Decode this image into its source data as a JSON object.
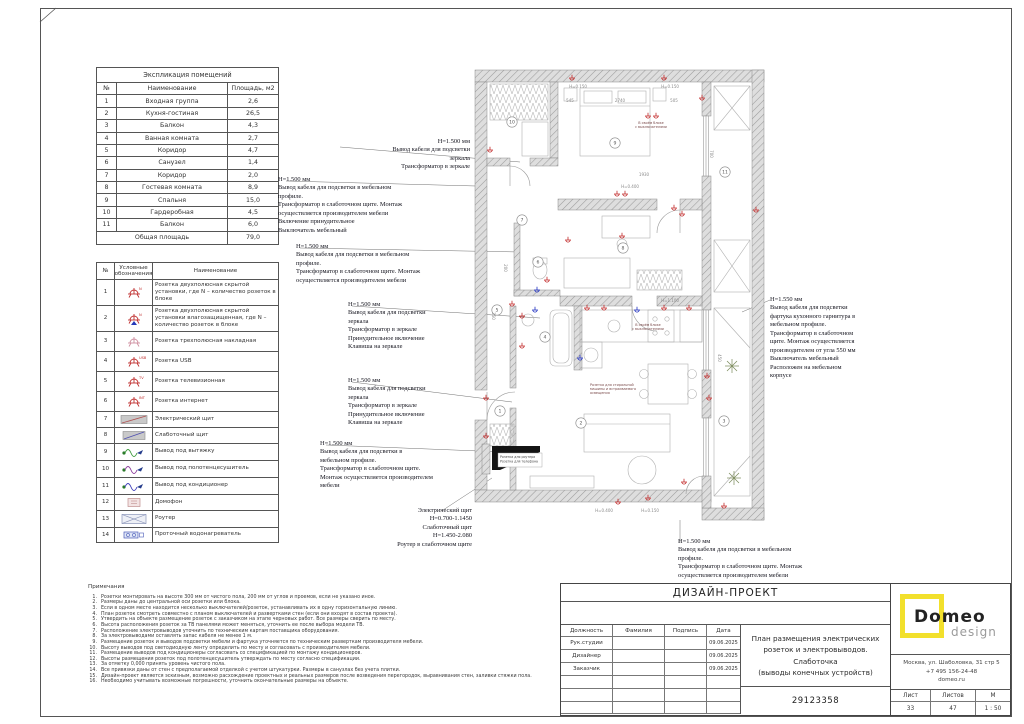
{
  "explication": {
    "title": "Экспликация помещений",
    "headers": [
      "№",
      "Наименование",
      "Площадь, м2"
    ],
    "rows": [
      [
        "1",
        "Входная группа",
        "2,6"
      ],
      [
        "2",
        "Кухня-гостиная",
        "26,5"
      ],
      [
        "3",
        "Балкон",
        "4,3"
      ],
      [
        "4",
        "Ванная комната",
        "2,7"
      ],
      [
        "5",
        "Коридор",
        "4,7"
      ],
      [
        "6",
        "Санузел",
        "1,4"
      ],
      [
        "7",
        "Коридор",
        "2,0"
      ],
      [
        "8",
        "Гостевая комната",
        "8,9"
      ],
      [
        "9",
        "Спальня",
        "15,0"
      ],
      [
        "10",
        "Гардеробная",
        "4,5"
      ],
      [
        "11",
        "Балкон",
        "6,0"
      ]
    ],
    "total_label": "Общая площадь",
    "total_value": "79,0"
  },
  "legend": {
    "headers": [
      "№",
      "Условные обозначения",
      "Наименование"
    ],
    "rows": [
      {
        "num": "1",
        "icon": "socket",
        "name": "Розетка двухполюсная скрытой установки, где N – количество розеток в блоке"
      },
      {
        "num": "2",
        "icon": "socket-wet",
        "name": "Розетка двухполюсная скрытой установки влагозащищенная, где N – количество розеток в блоке"
      },
      {
        "num": "3",
        "icon": "socket-surface",
        "name": "Розетка трехполюсная накладная"
      },
      {
        "num": "4",
        "icon": "socket-usb",
        "name": "Розетка USB"
      },
      {
        "num": "5",
        "icon": "socket-tv",
        "name": "Розетка телевизионная"
      },
      {
        "num": "6",
        "icon": "socket-int",
        "name": "Розетка интернет"
      },
      {
        "num": "7",
        "icon": "panel-el",
        "name": "Электрический щит"
      },
      {
        "num": "8",
        "icon": "panel-low",
        "name": "Слаботочный щит"
      },
      {
        "num": "9",
        "icon": "out-hood",
        "name": "Вывод под вытяжку"
      },
      {
        "num": "10",
        "icon": "out-towel",
        "name": "Вывод под полотенцесушитель"
      },
      {
        "num": "11",
        "icon": "out-ac",
        "name": "Вывод под кондиционер"
      },
      {
        "num": "12",
        "icon": "intercom",
        "name": "Домофон"
      },
      {
        "num": "13",
        "icon": "router",
        "name": "Роутер"
      },
      {
        "num": "14",
        "icon": "heater",
        "name": "Проточный водонагреватель"
      }
    ]
  },
  "annotations": [
    {
      "x": 302,
      "y": 138,
      "w": 168,
      "align": "right",
      "text": "H=1.500 мм\nВывод кабеля для подсветки\nзеркала\nТрансформатор в зеркале"
    },
    {
      "x": 278,
      "y": 176,
      "w": 196,
      "align": "left",
      "text": "H=1.500 мм\nВывод кабеля для подсветки в мебельном\nпрофиле.\nТрансформатор в слаботочном щите. Монтаж\nосуществляется производителем  мебели\nВключение принудительное\nВыключатель мебельный"
    },
    {
      "x": 296,
      "y": 243,
      "w": 184,
      "align": "left",
      "text": "H=1.500 мм\nВывод кабеля для подсветки в мебельном\nпрофиле.\nТрансформатор в слаботочном щите. Монтаж\nосуществляется производителем  мебели"
    },
    {
      "x": 348,
      "y": 301,
      "w": 122,
      "align": "left",
      "text": "H=1.500 мм\nВывод кабеля для подсветки\nзеркала\nТрансформатор в зеркале\nПринудительное включение\nКлавиша на зеркале"
    },
    {
      "x": 348,
      "y": 377,
      "w": 122,
      "align": "left",
      "text": "H=1.500 мм\nВывод кабеля для подсветки\nзеркала\nТрансформатор в зеркале\nПринудительное включение\nКлавиша на зеркале"
    },
    {
      "x": 320,
      "y": 440,
      "w": 152,
      "align": "left",
      "text": "H=1.500 мм\nВывод кабеля для подсветки в\nмебельном профиле.\nТрансформатор в слаботочном щите.\nМонтаж осуществляется производителем\nмебели"
    },
    {
      "x": 342,
      "y": 507,
      "w": 130,
      "align": "right",
      "text": "Электрический щит\nH=0.700-1.1450\nСлаботочный щит\nH=1.450-2.080\nРоутер в слаботочном щите"
    },
    {
      "x": 770,
      "y": 296,
      "w": 106,
      "align": "left",
      "text": "H=1.550 мм\nВывод кабеля для подсветки\nфартука кухонного гарнитура в\nмебельном профиле.\nТрансформатор в слаботочном\nщите. Монтаж осуществляется\nпроизводителем от угла  550 мм\nВыключатель мебельный\nРасположен на мебельном\nкорпусе"
    },
    {
      "x": 678,
      "y": 538,
      "w": 206,
      "align": "left",
      "text": "H=1.500 мм\nВывод кабеля для подсветки в мебельном\nпрофиле.\nТрансформатор в слаботочном щите. Монтаж\nосуществляется производителем  мебели"
    }
  ],
  "notes": {
    "title": "Примечания",
    "items": [
      "Розетки монтировать на высоте 300 мм от чистого пола, 200 мм от углов и проемов, если не указано иное.",
      "Размеры даны до центральной оси розетки или блока.",
      "Если в одном месте находится несколько выключателей/розеток, устанавливать их в одну горизонтальную линию.",
      "План розеток смотреть совместно с планом выключателей и развертками стен (если они входят в состав проекта).",
      "Утвердить на объекте размещение розеток с заказчиком на этапе черновых работ. Все размеры сверить по месту.",
      "Высота расположения розеток за ТВ панелями может меняться, уточнить ее после выбора модели ТВ.",
      "Расположение электровыводов уточнить по техническим картам поставщика оборудования.",
      "За электровыводами оставлять запас кабеля не менее 1 м.",
      "Размещение розеток и выводов подсветки мебели и фартука уточняется по техническим разверткам производителя мебели.",
      "Высоту выводов под светодиодную ленту определить по месту и согласовать с производителем мебели.",
      "Размещение выводов под кондиционеры согласовать со спецификацией по монтажу кондиционеров.",
      "Высоты размещения розеток под полотенцесушитель утверждать по месту согласно спецификации.",
      "За отметку 0,000 принять уровень чистого пола.",
      "Все привязки даны от стен с предполагаемой отделкой с учетом штукатурки. Размеры в санузлах без учета плитки.",
      "Дизайн-проект является эскизным, возможно расхождение проектных и реальных размеров после возведения перегородок, выравнивания стен, заливки стяжки пола.",
      "Необходимо учитывать возможные погрешности, уточнить окончательные размеры на объекте."
    ]
  },
  "plan": {
    "rooms": [
      {
        "n": "1",
        "x": 48,
        "y": 353
      },
      {
        "n": "2",
        "x": 129,
        "y": 365
      },
      {
        "n": "3",
        "x": 272,
        "y": 363
      },
      {
        "n": "4",
        "x": 93,
        "y": 279
      },
      {
        "n": "5",
        "x": 45,
        "y": 252
      },
      {
        "n": "6",
        "x": 86,
        "y": 204
      },
      {
        "n": "7",
        "x": 70,
        "y": 162
      },
      {
        "n": "8",
        "x": 171,
        "y": 190
      },
      {
        "n": "9",
        "x": 163,
        "y": 85
      },
      {
        "n": "10",
        "x": 60,
        "y": 64
      },
      {
        "n": "11",
        "x": 273,
        "y": 114
      }
    ],
    "outlets": [
      {
        "x": 120,
        "y": 20
      },
      {
        "x": 212,
        "y": 20
      },
      {
        "x": 250,
        "y": 40
      },
      {
        "x": 196,
        "y": 58
      },
      {
        "x": 204,
        "y": 58
      },
      {
        "x": 38,
        "y": 92
      },
      {
        "x": 165,
        "y": 136
      },
      {
        "x": 173,
        "y": 136
      },
      {
        "x": 222,
        "y": 150
      },
      {
        "x": 230,
        "y": 156
      },
      {
        "x": 304,
        "y": 152
      },
      {
        "x": 116,
        "y": 182
      },
      {
        "x": 170,
        "y": 178
      },
      {
        "x": 95,
        "y": 222
      },
      {
        "x": 85,
        "y": 232,
        "c": "b"
      },
      {
        "x": 70,
        "y": 258
      },
      {
        "x": 83,
        "y": 252,
        "c": "b"
      },
      {
        "x": 70,
        "y": 288
      },
      {
        "x": 135,
        "y": 250
      },
      {
        "x": 152,
        "y": 250
      },
      {
        "x": 185,
        "y": 252,
        "c": "b"
      },
      {
        "x": 212,
        "y": 250
      },
      {
        "x": 237,
        "y": 250
      },
      {
        "x": 128,
        "y": 300,
        "c": "b"
      },
      {
        "x": 60,
        "y": 246
      },
      {
        "x": 255,
        "y": 318
      },
      {
        "x": 257,
        "y": 340
      },
      {
        "x": 34,
        "y": 340
      },
      {
        "x": 34,
        "y": 378
      },
      {
        "x": 166,
        "y": 444
      },
      {
        "x": 196,
        "y": 440
      },
      {
        "x": 232,
        "y": 424
      },
      {
        "x": 272,
        "y": 448
      }
    ],
    "dims": [
      {
        "x": 118,
        "y": 44,
        "t": "545"
      },
      {
        "x": 168,
        "y": 44,
        "t": "2740"
      },
      {
        "x": 222,
        "y": 44,
        "t": "505"
      },
      {
        "x": 126,
        "y": 30,
        "t": "H=0.150"
      },
      {
        "x": 218,
        "y": 30,
        "t": "H=0.150"
      },
      {
        "x": 192,
        "y": 118,
        "t": "1930"
      },
      {
        "x": 178,
        "y": 130,
        "t": "H=0.400"
      },
      {
        "x": 258,
        "y": 96,
        "t": "700",
        "r": 90
      },
      {
        "x": 52,
        "y": 210,
        "t": "200",
        "r": 90
      },
      {
        "x": 40,
        "y": 258,
        "t": "250",
        "r": 90
      },
      {
        "x": 218,
        "y": 244,
        "t": "H=1.100"
      },
      {
        "x": 266,
        "y": 300,
        "t": "450",
        "r": 90
      },
      {
        "x": 152,
        "y": 454,
        "t": "H=0.400"
      },
      {
        "x": 198,
        "y": 454,
        "t": "H=0.150"
      }
    ],
    "captions": [
      {
        "x": 199,
        "y": 66,
        "anchor": "middle",
        "lines": [
          "В своём блоке",
          "с выключателями"
        ]
      },
      {
        "x": 196,
        "y": 268,
        "anchor": "middle",
        "lines": [
          "В своём блоке",
          "с выключателями"
        ]
      },
      {
        "x": 138,
        "y": 328,
        "anchor": "start",
        "lines": [
          "Розетка для стиральной",
          "машины и встраиваемого",
          "освещения"
        ]
      }
    ],
    "router_label": [
      "Розетка для роутера",
      "Розетка для телефона"
    ]
  },
  "titleblock": {
    "project": "ДИЗАЙН-ПРОЕКТ",
    "sign_headers": [
      "Должность",
      "Фамилия",
      "Подпись",
      "Дата"
    ],
    "sign_rows": [
      {
        "role": "Рук.студии",
        "fio": "",
        "sign": "",
        "date": "09.06.2025"
      },
      {
        "role": "Дизайнер",
        "fio": "",
        "sign": "",
        "date": "09.06.2025"
      },
      {
        "role": "Заказчик",
        "fio": "",
        "sign": "",
        "date": "09.06.2025"
      }
    ],
    "sheet_title": "План размещения электрических\nрозеток и электровыводов.\nСлаботочка\n(выводы конечных устройств)",
    "doc_number": "29123358",
    "logo_text": "Domeo",
    "logo_sub": "design",
    "address": "Москва, ул. Шаболовка, 31 стр 5",
    "phone": "+7 495 156-24-48",
    "site": "domeo.ru",
    "sheet_cols": [
      "Лист",
      "Листов",
      "М"
    ],
    "sheet_vals": [
      "33",
      "47",
      "1 : 50"
    ]
  }
}
